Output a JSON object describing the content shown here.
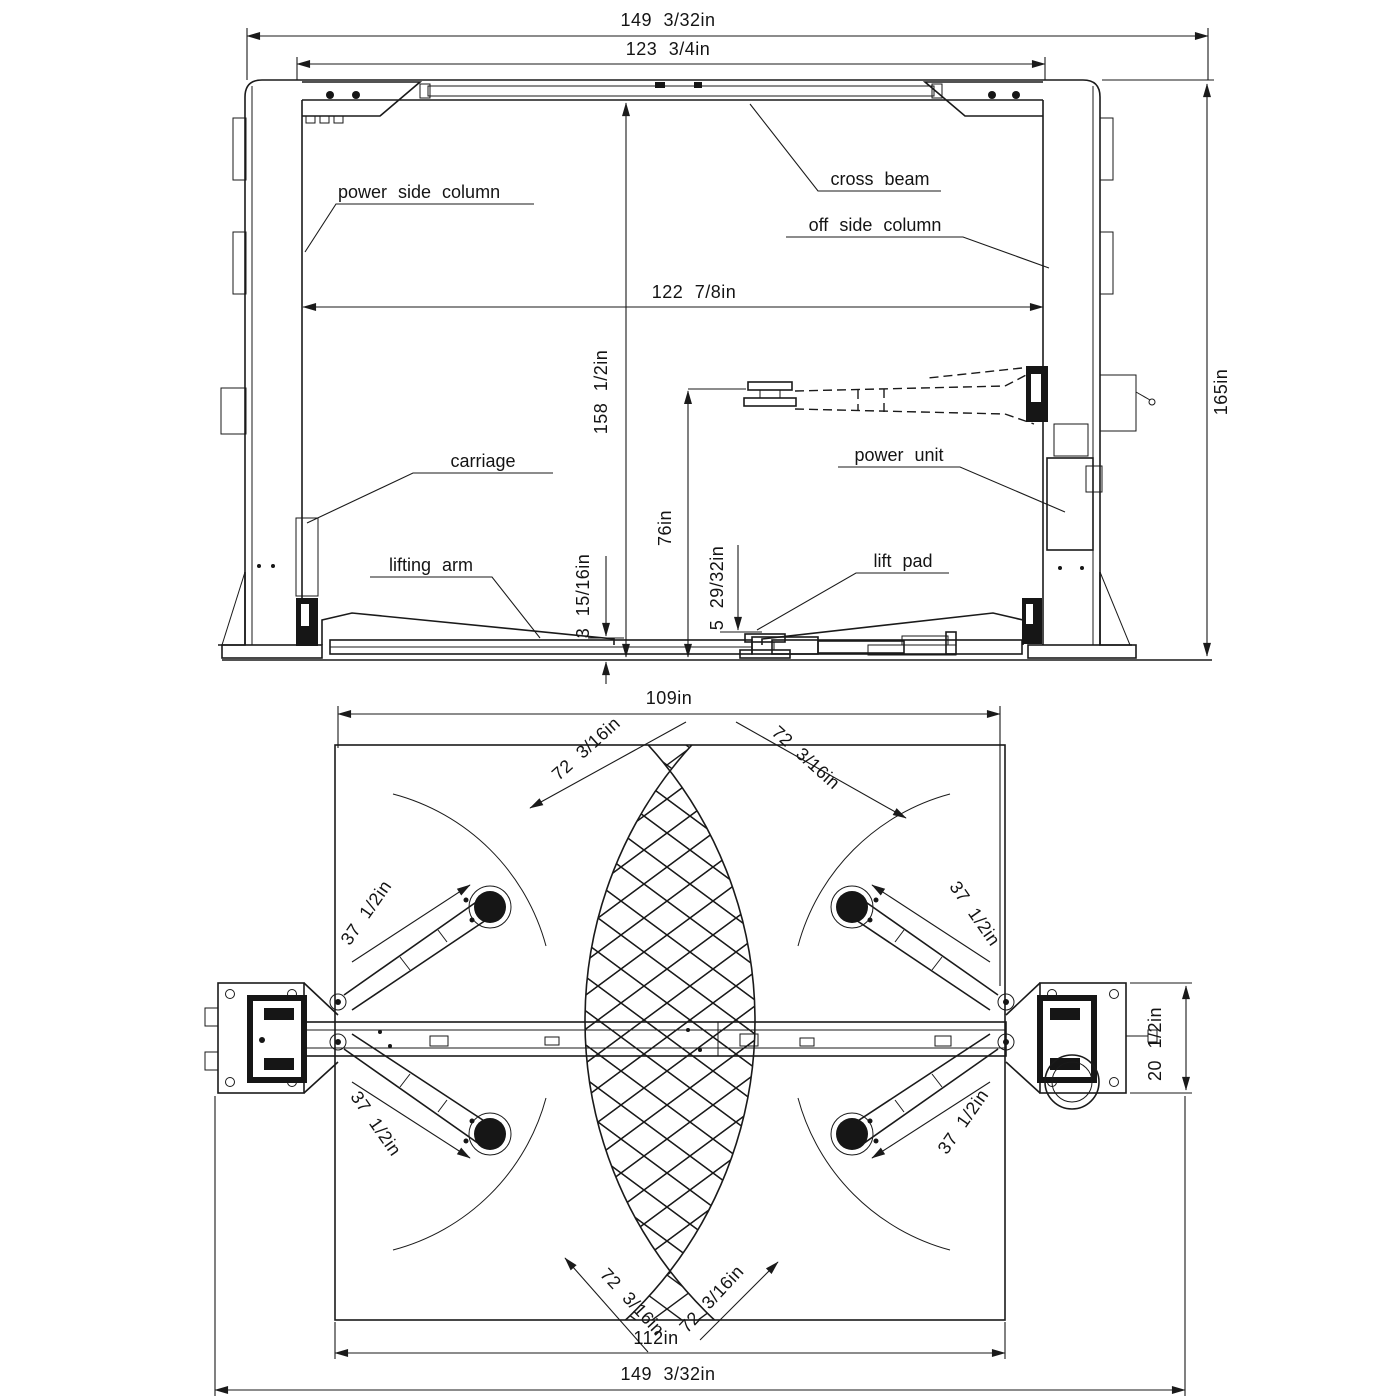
{
  "colors": {
    "ink": "#1a1a1a",
    "paper": "#ffffff"
  },
  "front": {
    "labels": {
      "power_side_column": "power side column",
      "cross_beam": "cross beam",
      "off_side_column": "off side column",
      "carriage": "carriage",
      "power_unit": "power unit",
      "lifting_arm": "lifting arm",
      "lift_pad": "lift pad"
    },
    "dims": {
      "overall_width": "149 3/32in",
      "inner_width": "123 3/4in",
      "clear_width": "122 7/8in",
      "overall_height": "165in",
      "column_height": "158 1/2in",
      "max_lift_height": "76in",
      "pad_min_height": "5 29/32in",
      "arm_min_height": "3 15/16in"
    }
  },
  "plan": {
    "dims": {
      "inside_width": "109in",
      "arm_reach_max": "72 3/16in",
      "arm_reach_min": "37 1/2in",
      "baseplate_width": "20 1/2in",
      "base_width": "112in",
      "overall_width": "149 3/32in"
    }
  }
}
